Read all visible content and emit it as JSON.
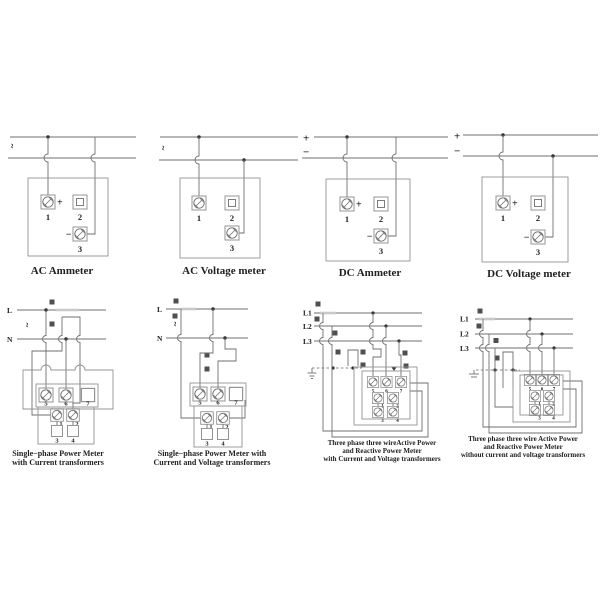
{
  "colors": {
    "wire": "#6f6f6f",
    "box": "#949494",
    "symbol": "#4f4f4f",
    "text": "#212121",
    "background": "#ffffff"
  },
  "diagrams": {
    "ac_ammeter": {
      "caption": "AC Ammeter",
      "source": "~",
      "term_plus": "+",
      "term_minus": "−",
      "t1": "1",
      "t2": "2",
      "t3": "3"
    },
    "ac_voltmeter": {
      "caption": "AC Voltage meter",
      "source": "~",
      "t1": "1",
      "t2": "2",
      "t3": "3"
    },
    "dc_ammeter": {
      "caption": "DC Ammeter",
      "line_plus": "+",
      "line_minus": "−",
      "term_plus": "+",
      "term_minus": "−",
      "t1": "1",
      "t2": "2",
      "t3": "3"
    },
    "dc_voltmeter": {
      "caption": "DC Voltage meter",
      "line_plus": "+",
      "line_minus": "−",
      "term_plus": "+",
      "term_minus": "−",
      "t1": "1",
      "t2": "2",
      "t3": "3"
    },
    "sp_ct": {
      "caption1": "Single−phase Power Meter",
      "caption2": "with Current transformers",
      "line_l": "L",
      "line_n": "N",
      "source": "~",
      "t5": "5",
      "t6": "6",
      "t7": "7",
      "t1": "1",
      "t2": "2",
      "t3": "3",
      "t4": "4"
    },
    "sp_ct_vt": {
      "caption1": "Single−phase Power Meter with",
      "caption2": "Current and Voltage transformers",
      "line_l": "L",
      "line_n": "N",
      "source": "~",
      "t5": "5",
      "t6": "6",
      "t7": "7",
      "t1": "1",
      "t2": "2",
      "t3": "3",
      "t4": "4"
    },
    "tp_ct_vt": {
      "caption1": "Three phase three wireActive Power",
      "caption2": "and Reactive Power Meter",
      "caption3": "with Current and Voltage transformers",
      "line_l1": "L1",
      "line_l2": "L2",
      "line_l3": "L3",
      "t5": "5",
      "t6": "6",
      "t7": "7",
      "t1": "1",
      "t2": "2",
      "t3": "3",
      "t4": "4"
    },
    "tp_direct": {
      "caption1": "Three phase three wire Active Power",
      "caption2": "and Reactive Power Meter",
      "caption3": "without current and voltage transformers",
      "line_l1": "L1",
      "line_l2": "L2",
      "line_l3": "L3",
      "t5": "5",
      "t6": "6",
      "t7": "7",
      "t1": "1",
      "t2": "2",
      "t3": "3",
      "t4": "4"
    }
  }
}
